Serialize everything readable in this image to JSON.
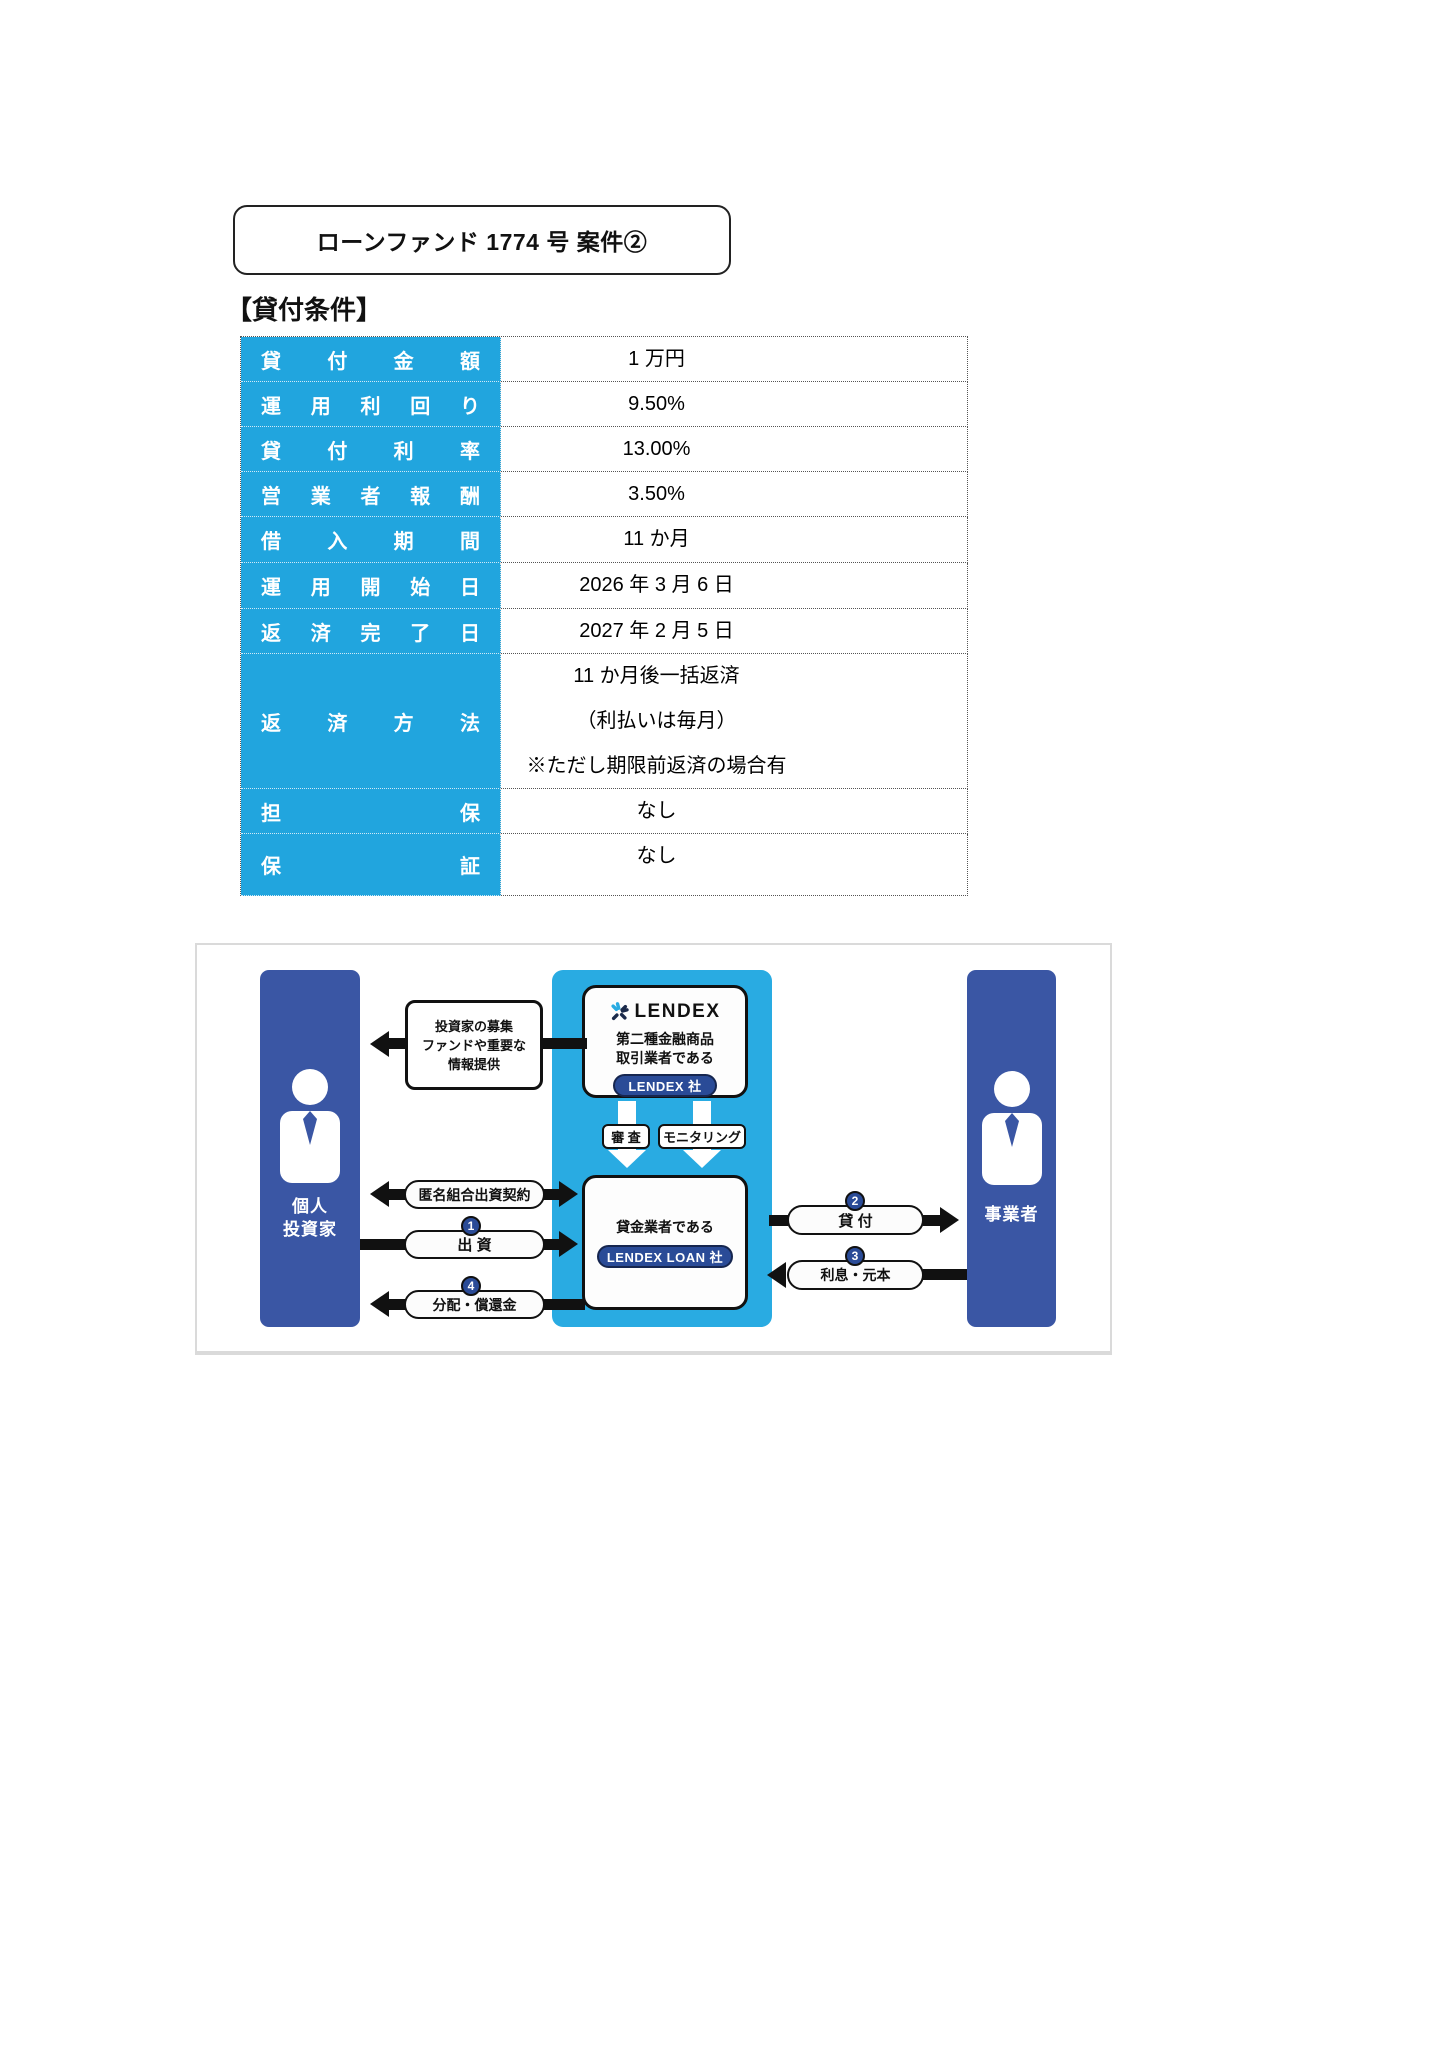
{
  "title": "ローンファンド 1774 号 案件②",
  "section_heading": "【貸付条件】",
  "table": {
    "header_bg": "#21A5DE",
    "header_text_color": "#ffffff",
    "rows": [
      {
        "label": "貸付金額",
        "value": "1 万円"
      },
      {
        "label": "運用利回り",
        "value": "9.50%"
      },
      {
        "label": "貸付利率",
        "value": "13.00%"
      },
      {
        "label": "営業者報酬",
        "value": "3.50%"
      },
      {
        "label": "借入期間",
        "value": "11 か月"
      },
      {
        "label": "運用開始日",
        "value": "2026 年 3 月 6 日"
      },
      {
        "label": "返済完了日",
        "value": "2027 年 2 月 5 日"
      },
      {
        "label": "返済方法",
        "value_lines": [
          "11 か月後一括返済",
          "（利払いは毎月）",
          "※ただし期限前返済の場合有"
        ]
      },
      {
        "label": "担保",
        "value": "なし"
      },
      {
        "label": "保証",
        "value": "なし"
      }
    ]
  },
  "diagram": {
    "colors": {
      "cyan": "#29ABE2",
      "navy": "#3A56A4",
      "pill_navy": "#2A4B97"
    },
    "investor": {
      "label_line1": "個人",
      "label_line2": "投資家"
    },
    "business": {
      "label": "事業者"
    },
    "info_box": {
      "line1": "投資家の募集",
      "line2": "ファンドや重要な",
      "line3": "情報提供"
    },
    "lendex_card": {
      "logo_word": "LENDEX",
      "line1": "第二種金融商品",
      "line2": "取引業者である",
      "pill": "LENDEX 社"
    },
    "loan_card": {
      "line": "貸金業者である",
      "pill": "LENDEX LOAN 社"
    },
    "check_label": "審 査",
    "monitor_label": "モニタリング",
    "flows": {
      "anonymous_contract": "匿名組合出資契約",
      "investment": {
        "num": "1",
        "label": "出 資"
      },
      "distribution": {
        "num": "4",
        "label": "分配・償還金"
      },
      "loan": {
        "num": "2",
        "label": "貸 付"
      },
      "interest": {
        "num": "3",
        "label": "利息・元本"
      }
    }
  }
}
